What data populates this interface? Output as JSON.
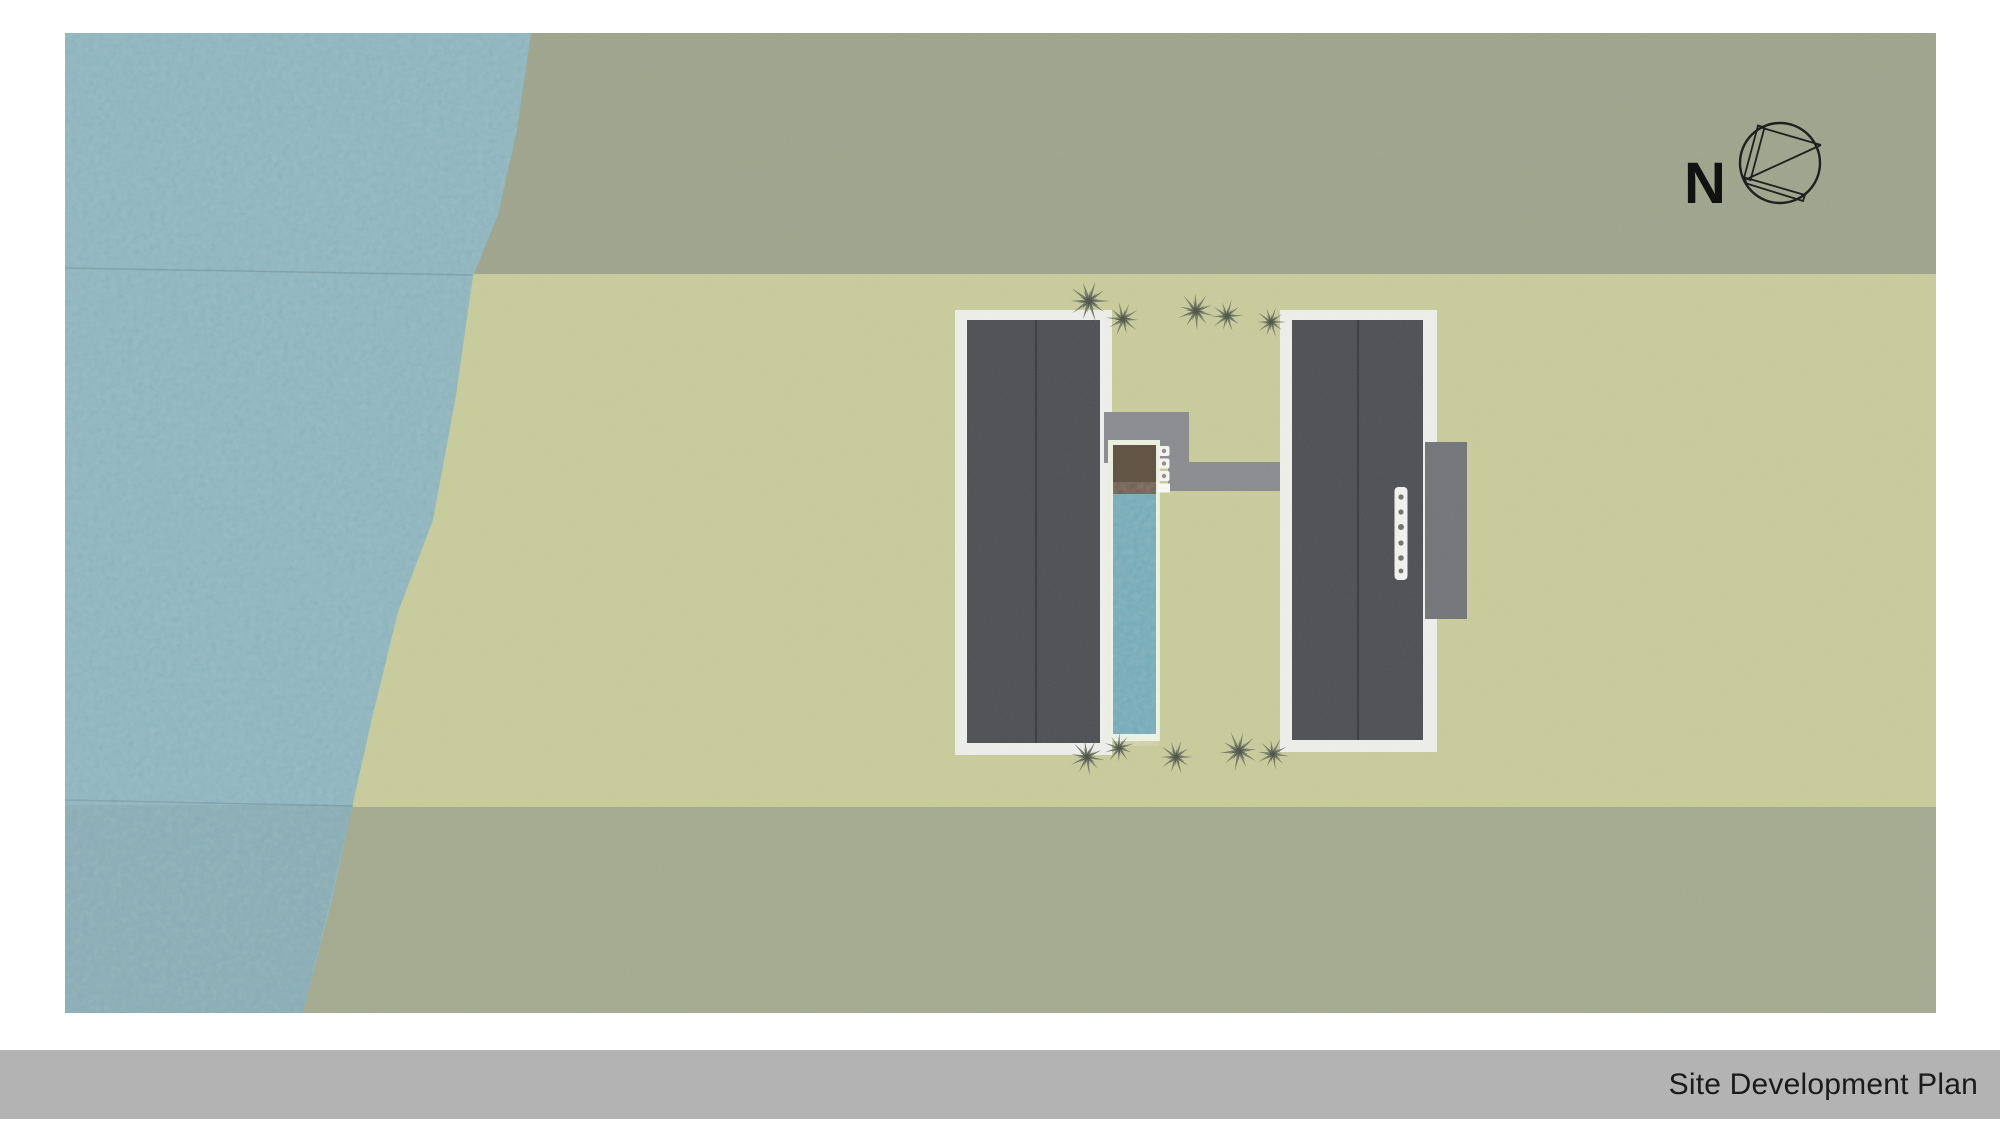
{
  "title_bar": {
    "label": "Site Development Plan",
    "background": "#b3b3b3",
    "text_color": "#1a1a1a"
  },
  "compass": {
    "label": "N"
  },
  "plan": {
    "features": [
      "water-body",
      "upper-field-band",
      "middle-field-band",
      "lower-field-band",
      "left-building-roof",
      "right-building-roof",
      "perimeter-walkway-left",
      "perimeter-walkway-right",
      "connecting-path",
      "lap-pool",
      "pool-wood-deck",
      "side-deck",
      "stepping-stones",
      "pool-loungers",
      "trees",
      "north-compass"
    ],
    "colors": {
      "water": "#7ca9b3",
      "upper_field": "#9aa087",
      "middle_field": "#c4c896",
      "lower_field": "#a0a689",
      "building_roof": "#47494c",
      "perimeter_walkway": "#ebebe8",
      "connecting_path": "#85868a",
      "side_deck": "#6d6f72",
      "pool_water": "#5f9dac",
      "pool_wood_deck": "#584a3a",
      "pool_frame": "#e7eedd",
      "tree": "#757b6a",
      "title_bar_background": "#b3b3b3"
    }
  }
}
